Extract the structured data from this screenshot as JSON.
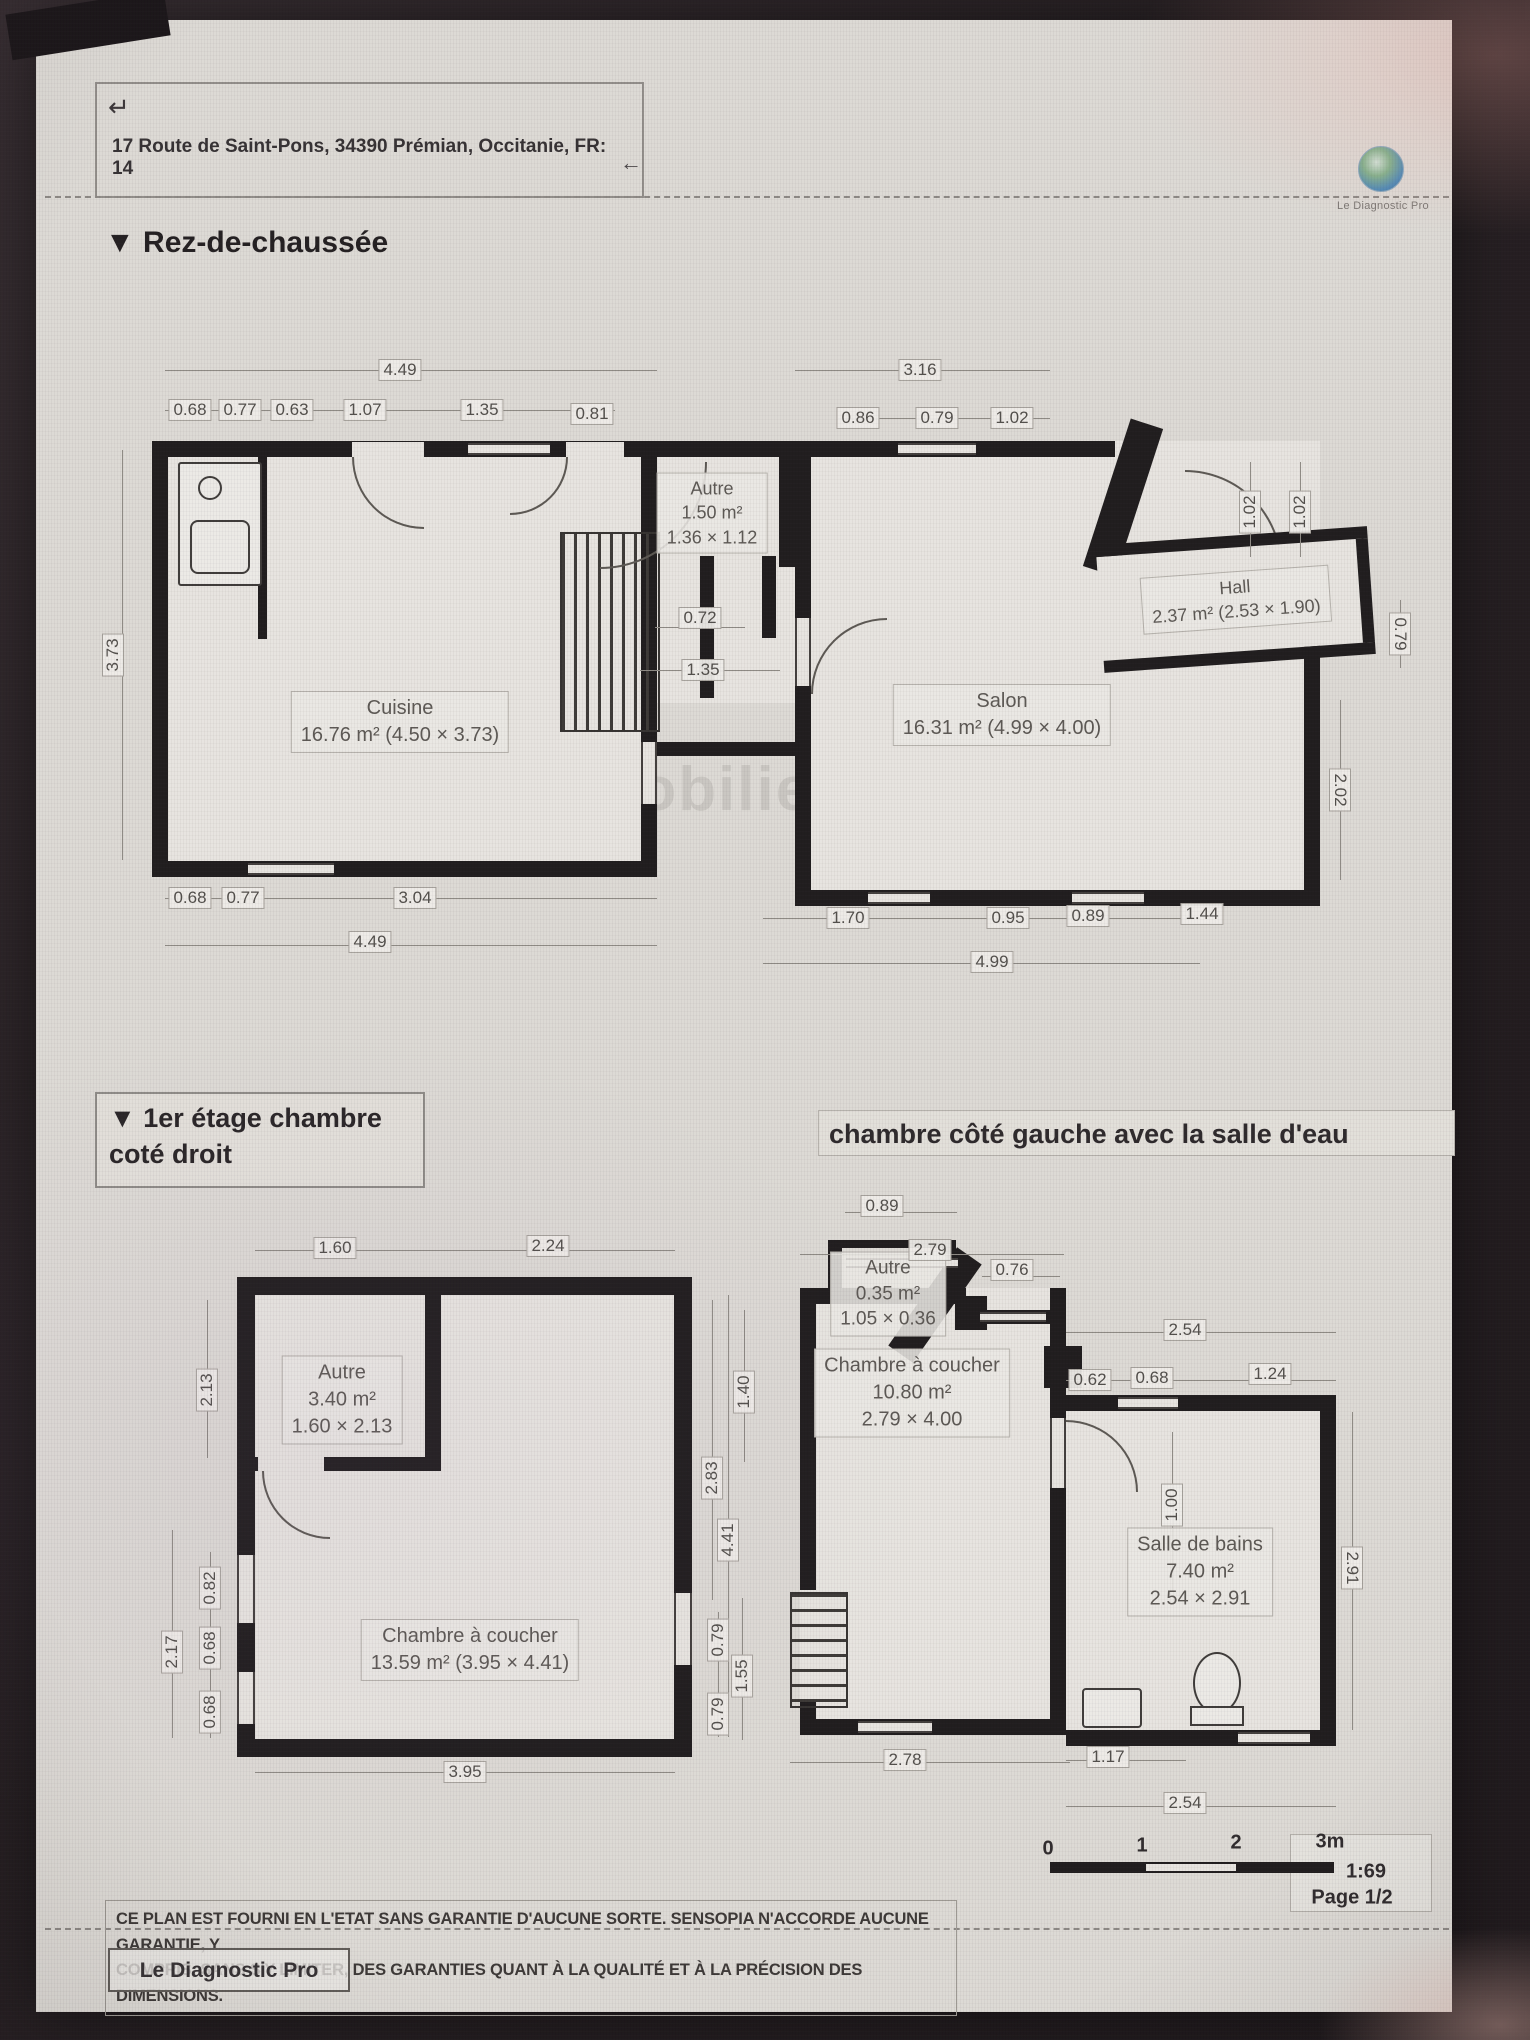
{
  "header": {
    "return_icon": "↵",
    "back_icon": "←",
    "address": "17 Route de Saint-Pons, 34390 Prémian, Occitanie, FR: 14",
    "logo_text": "Le Diagnostic Pro"
  },
  "sections": {
    "ground": {
      "marker": "▼",
      "title": "Rez-de-chaussée"
    },
    "floor_right": {
      "marker": "▼",
      "title_line1": "1er étage chambre",
      "title_line2": "coté droit"
    },
    "floor_left": {
      "title": "chambre côté gauche avec la salle d'eau"
    }
  },
  "watermark": {
    "brand": "bskimmobilier",
    "sub": "Le Diagnos"
  },
  "rooms": {
    "cuisine": {
      "name": "Cuisine",
      "area": "16.76 m² (4.50 × 3.73)"
    },
    "salon": {
      "name": "Salon",
      "area": "16.31 m² (4.99 × 4.00)"
    },
    "hall": {
      "name": "Hall",
      "area": "2.37 m² (2.53 × 1.90)"
    },
    "autre_rdc": {
      "name": "Autre",
      "area": "1.50 m²",
      "dims": "1.36 × 1.12"
    },
    "autre_etage_droit": {
      "name": "Autre",
      "area": "3.40 m²",
      "dims": "1.60 × 2.13"
    },
    "chambre_droite": {
      "name": "Chambre à coucher",
      "area": "13.59 m² (3.95 × 4.41)"
    },
    "autre_etage_gauche": {
      "name": "Autre",
      "area": "0.35 m²",
      "dims": "1.05 × 0.36"
    },
    "chambre_gauche": {
      "name": "Chambre à coucher",
      "area": "10.80 m²",
      "dims": "2.79 × 4.00"
    },
    "salle_de_bains": {
      "name": "Salle de bains",
      "area": "7.40 m²",
      "dims": "2.54 × 2.91"
    }
  },
  "dims": {
    "rdc": {
      "top_total": "4.49",
      "t1": "0.68",
      "t2": "0.77",
      "t3": "0.63",
      "t4": "1.07",
      "t5": "1.35",
      "t6": "0.81",
      "top_total_r": "3.16",
      "t7": "0.86",
      "t8": "0.79",
      "t9": "1.02",
      "left_v": "3.73",
      "mid1": "0.72",
      "mid2": "1.35",
      "rv1": "1.02",
      "rv2": "1.02",
      "rv3": "0.79",
      "rv4": "2.02",
      "b1": "0.68",
      "b2": "0.77",
      "b3": "3.04",
      "bottom_total": "4.49",
      "b4": "1.70",
      "b5": "0.95",
      "b6": "0.89",
      "b7": "1.44",
      "bottom_total_r": "4.99"
    },
    "etage_droit": {
      "t1": "1.60",
      "t2": "2.24",
      "lv1": "2.13",
      "lv2": "0.82",
      "lv3": "0.68",
      "lv4": "2.17",
      "lv5": "0.68",
      "rv1": "1.40",
      "rv2": "2.83",
      "rv3": "4.41",
      "rv4": "0.79",
      "rv5": "1.55",
      "rv6": "0.79",
      "b1": "3.95"
    },
    "etage_gauche": {
      "t1": "0.89",
      "t2": "2.79",
      "door": "0.76",
      "bath_top": "2.54",
      "bt1": "0.62",
      "bt2": "0.68",
      "bt3": "1.24",
      "bath_rv": "2.91",
      "bath_lv": "1.00",
      "b1": "2.78",
      "b2": "1.17",
      "b3": "2.54"
    }
  },
  "footer": {
    "disclaimer_line1": "CE PLAN EST FOURNI EN L'ETAT SANS GARANTIE D'AUCUNE SORTE. SENSOPIA N'ACCORDE AUCUNE GARANTIE, Y",
    "disclaimer_line2": "COMPRIS, SANS S'Y LIMITER, DES GARANTIES QUANT À LA QUALITÉ ET À LA PRÉCISION DES DIMENSIONS.",
    "scale": {
      "t0": "0",
      "t1": "1",
      "t2": "2",
      "t3": "3m",
      "ratio": "1:69",
      "page": "Page 1/2"
    },
    "brand": "Le Diagnostic Pro"
  }
}
